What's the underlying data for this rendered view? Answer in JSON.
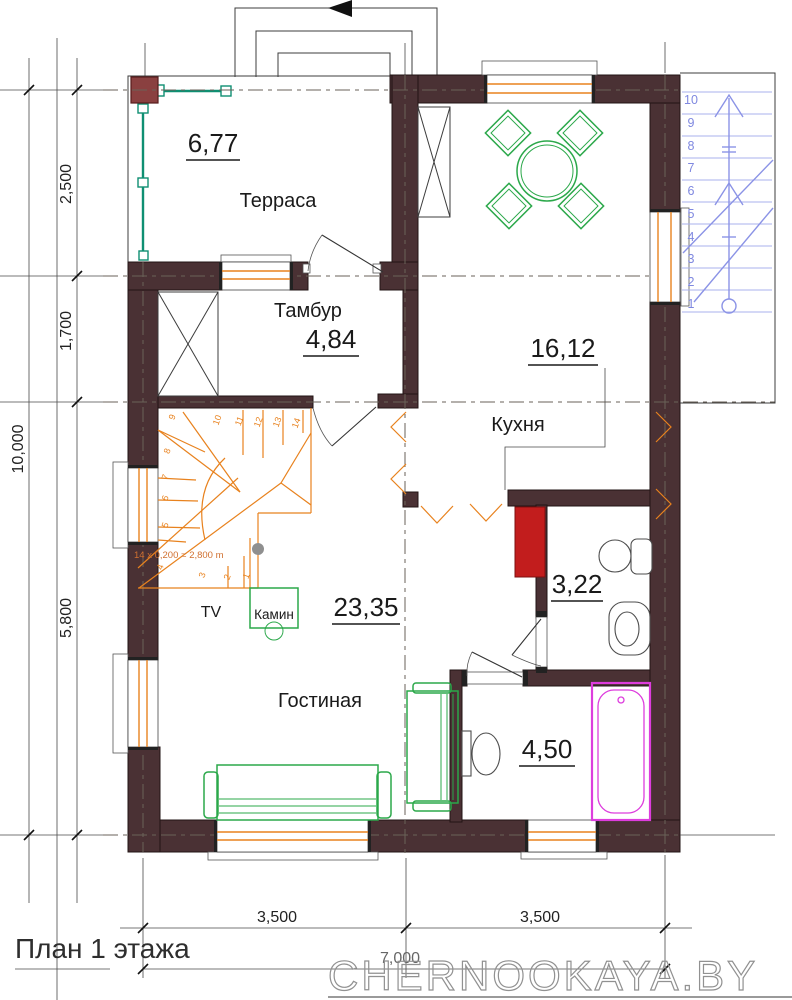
{
  "title": "План 1 этажа",
  "watermark": "CHERNOOKAYA.BY",
  "rooms": {
    "terrace": {
      "name": "Терраса",
      "area": "6,77"
    },
    "tambour": {
      "name": "Тамбур",
      "area": "4,84"
    },
    "kitchen": {
      "name": "Кухня",
      "area": "16,12"
    },
    "living": {
      "name": "Гостиная",
      "area": "23,35"
    },
    "wc": {
      "area": "3,22"
    },
    "bath": {
      "area": "4,50"
    }
  },
  "labels": {
    "tv": "TV",
    "fireplace": "Камин"
  },
  "stairs": {
    "note": "14 х 0,200 = 2,800 m",
    "interior_steps": [
      "1",
      "2",
      "3",
      "4",
      "5",
      "6",
      "7",
      "8",
      "9",
      "10",
      "11",
      "12",
      "13",
      "14"
    ],
    "exterior_steps": [
      "1",
      "2",
      "3",
      "4",
      "5",
      "6",
      "7",
      "8",
      "9",
      "10"
    ]
  },
  "dimensions": {
    "left_segments": [
      "2,500",
      "1,700",
      "5,800"
    ],
    "left_total": "10,000",
    "bottom_segments": [
      "3,500",
      "3,500"
    ],
    "bottom_total": "7,000"
  },
  "colors": {
    "wall": "#4a3134",
    "window": "#e8821e",
    "stair_interior": "#e8821e",
    "furniture": "#2ba84a",
    "railing": "#0f8f72",
    "bathtub": "#dd3ddd",
    "stair_exterior": "#8b93e6",
    "flue": "#c21d1d",
    "column": "#8a4040"
  }
}
